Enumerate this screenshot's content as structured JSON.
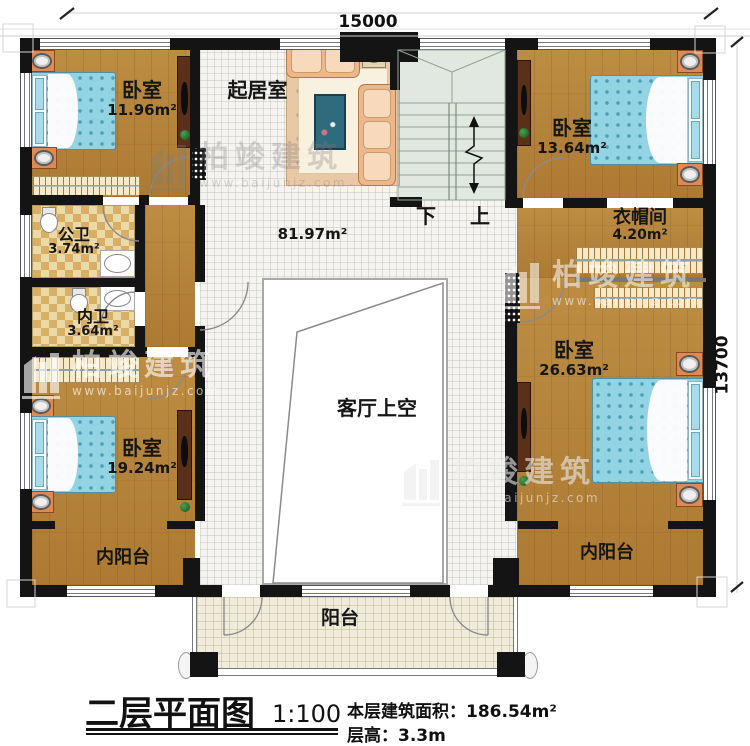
{
  "watermark": {
    "brand": "柏竣建筑",
    "url": "www.baijunjz.com"
  },
  "dimensions": {
    "top": "15000",
    "right": "13700"
  },
  "stairs": {
    "down": "下",
    "up": "上"
  },
  "rooms": {
    "bedroom_tl": {
      "name": "卧室",
      "area": "11.96m²"
    },
    "living_room": {
      "name": "起居室"
    },
    "hall": {
      "area": "81.97m²"
    },
    "bedroom_tr": {
      "name": "卧室",
      "area": "13.64m²"
    },
    "cloakroom": {
      "name": "衣帽间",
      "area": "4.20m²"
    },
    "public_bathroom": {
      "name": "公卫",
      "area": "3.74m²"
    },
    "ensuite_bathroom": {
      "name": "内卫",
      "area": "3.64m²"
    },
    "void": {
      "name": "客厅上空"
    },
    "bedroom_bl": {
      "name": "卧室",
      "area": "19.24m²"
    },
    "bedroom_br": {
      "name": "卧室",
      "area": "26.63m²"
    },
    "inner_balcony_left": {
      "name": "内阳台"
    },
    "inner_balcony_right": {
      "name": "内阳台"
    },
    "balcony": {
      "name": "阳台"
    }
  },
  "title_block": {
    "title": "二层平面图",
    "scale": "1:100",
    "floor_area_label": "本层建筑面积：",
    "floor_area_value": "186.54m²",
    "floor_height_label": "层高：",
    "floor_height_value": "3.3m"
  }
}
